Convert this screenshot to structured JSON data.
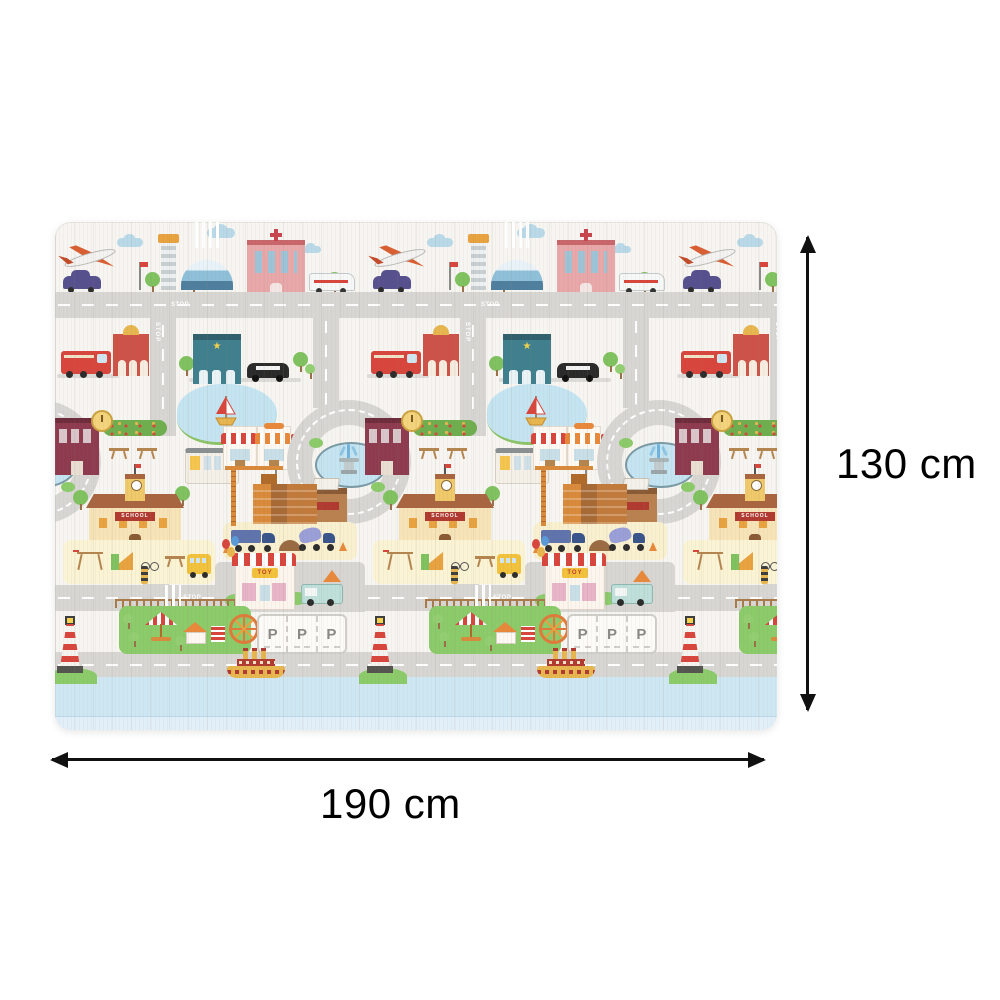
{
  "annotations": {
    "height_label": "130 cm",
    "width_label": "190 cm"
  },
  "mat": {
    "description": "baby play mat with city road-map pattern",
    "labels": {
      "stop": "STOP",
      "school": "SCHOOL",
      "toy": "TOY",
      "parking": "P",
      "police_star": "★"
    },
    "colors": {
      "mat_base": "#f7f5f1",
      "road_gray": "#d7d6d3",
      "water_blue": "#cfe7f3",
      "grass_green": "#8ccb6a",
      "playground_yellow": "#faf3d4",
      "cloud_blue": "#b9d9e8",
      "roof_red": "#d8453c",
      "arrow_black": "#111111"
    }
  }
}
